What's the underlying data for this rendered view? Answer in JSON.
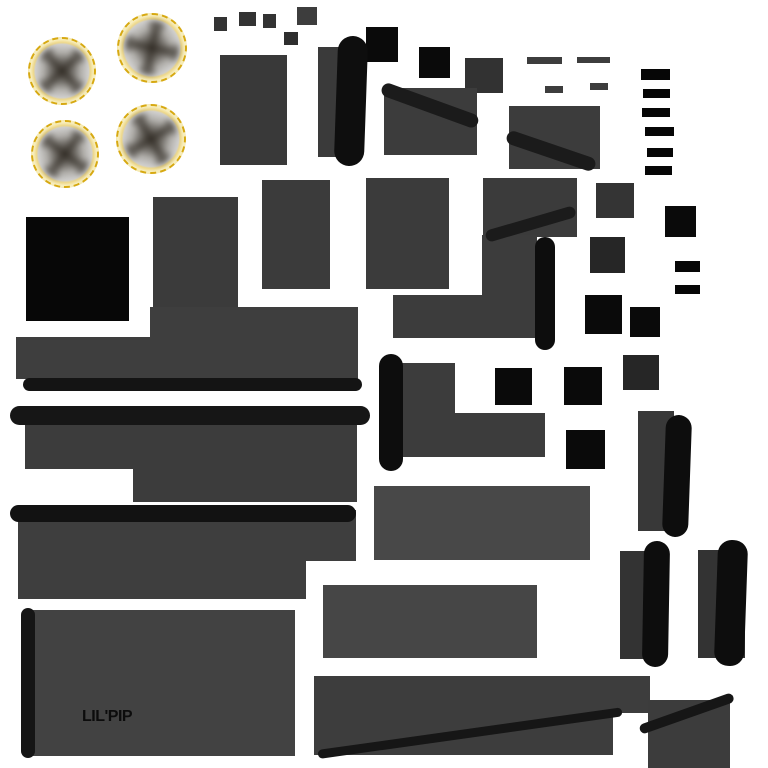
{
  "canvas": {
    "width": 768,
    "height": 768,
    "background": "#ffffff"
  },
  "label": {
    "text": "LIL'PIP"
  },
  "palette": {
    "background": "#ffffff",
    "panel_gray": "#3a3a3a",
    "panel_gray_light": "#464646",
    "strap_black": "#0d0d0d",
    "bar_black": "#1b1b1b",
    "square_black": "#0a0a0a",
    "wheel_rim_gold": "#d7a912",
    "wheel_glow_gold": "#f6e8ad",
    "wheel_disc_gray": "#cfcecc",
    "label_color": "#0c0c0c"
  },
  "shapes": [
    {
      "name": "wheel-top-left",
      "kind": "wheel",
      "x": 28,
      "y": 37,
      "w": 68,
      "h": 68,
      "spoke_rot": 40
    },
    {
      "name": "wheel-top-right",
      "kind": "wheel",
      "x": 117,
      "y": 13,
      "w": 70,
      "h": 70,
      "spoke_rot": 5
    },
    {
      "name": "wheel-bottom-left",
      "kind": "wheel",
      "x": 31,
      "y": 120,
      "w": 68,
      "h": 68,
      "spoke_rot": 30
    },
    {
      "name": "wheel-bottom-right",
      "kind": "wheel",
      "x": 116,
      "y": 104,
      "w": 70,
      "h": 70,
      "spoke_rot": 52
    },
    {
      "name": "chip-1",
      "kind": "rect",
      "x": 214,
      "y": 17,
      "w": 13,
      "h": 14,
      "color": "#333333"
    },
    {
      "name": "chip-2",
      "kind": "rect",
      "x": 239,
      "y": 12,
      "w": 17,
      "h": 14,
      "color": "#333333"
    },
    {
      "name": "chip-3",
      "kind": "rect",
      "x": 263,
      "y": 14,
      "w": 13,
      "h": 14,
      "color": "#333333"
    },
    {
      "name": "chip-4",
      "kind": "rect",
      "x": 284,
      "y": 32,
      "w": 14,
      "h": 13,
      "color": "#2e2e2e"
    },
    {
      "name": "chip-5",
      "kind": "rect",
      "x": 297,
      "y": 7,
      "w": 20,
      "h": 18,
      "color": "#3d3d3d"
    },
    {
      "name": "dash-1",
      "kind": "rect",
      "x": 527,
      "y": 57,
      "w": 35,
      "h": 7,
      "color": "#3d3d3d"
    },
    {
      "name": "dash-2",
      "kind": "rect",
      "x": 577,
      "y": 57,
      "w": 33,
      "h": 6,
      "color": "#3d3d3d"
    },
    {
      "name": "dash-3",
      "kind": "rect",
      "x": 545,
      "y": 86,
      "w": 18,
      "h": 7,
      "color": "#3d3d3d"
    },
    {
      "name": "dash-4",
      "kind": "rect",
      "x": 590,
      "y": 83,
      "w": 18,
      "h": 7,
      "color": "#3d3d3d"
    },
    {
      "name": "black-dash-1",
      "kind": "rect",
      "x": 641,
      "y": 69,
      "w": 29,
      "h": 11,
      "color": "#060606"
    },
    {
      "name": "black-dash-2",
      "kind": "rect",
      "x": 643,
      "y": 89,
      "w": 27,
      "h": 9,
      "color": "#060606"
    },
    {
      "name": "black-dash-3",
      "kind": "rect",
      "x": 642,
      "y": 108,
      "w": 28,
      "h": 9,
      "color": "#060606"
    },
    {
      "name": "black-dash-4",
      "kind": "rect",
      "x": 645,
      "y": 127,
      "w": 29,
      "h": 9,
      "color": "#060606"
    },
    {
      "name": "black-dash-5",
      "kind": "rect",
      "x": 647,
      "y": 148,
      "w": 26,
      "h": 9,
      "color": "#060606"
    },
    {
      "name": "black-dash-6",
      "kind": "rect",
      "x": 645,
      "y": 166,
      "w": 27,
      "h": 9,
      "color": "#060606"
    },
    {
      "name": "black-dash-7",
      "kind": "rect",
      "x": 675,
      "y": 261,
      "w": 25,
      "h": 11,
      "color": "#060606"
    },
    {
      "name": "black-dash-8",
      "kind": "rect",
      "x": 675,
      "y": 285,
      "w": 25,
      "h": 9,
      "color": "#060606"
    },
    {
      "name": "black-square-1",
      "kind": "rect",
      "x": 366,
      "y": 27,
      "w": 32,
      "h": 35,
      "color": "#0a0a0a"
    },
    {
      "name": "black-square-2",
      "kind": "rect",
      "x": 419,
      "y": 47,
      "w": 31,
      "h": 31,
      "color": "#0a0a0a"
    },
    {
      "name": "black-square-3",
      "kind": "rect",
      "x": 665,
      "y": 206,
      "w": 31,
      "h": 31,
      "color": "#0a0a0a"
    },
    {
      "name": "black-square-4",
      "kind": "rect",
      "x": 26,
      "y": 217,
      "w": 103,
      "h": 104,
      "color": "#070707"
    },
    {
      "name": "black-square-5",
      "kind": "rect",
      "x": 585,
      "y": 295,
      "w": 37,
      "h": 39,
      "color": "#0a0a0a"
    },
    {
      "name": "black-square-6",
      "kind": "rect",
      "x": 630,
      "y": 307,
      "w": 30,
      "h": 30,
      "color": "#0a0a0a"
    },
    {
      "name": "black-square-7",
      "kind": "rect",
      "x": 495,
      "y": 368,
      "w": 37,
      "h": 37,
      "color": "#0a0a0a"
    },
    {
      "name": "black-square-8",
      "kind": "rect",
      "x": 564,
      "y": 367,
      "w": 38,
      "h": 38,
      "color": "#0a0a0a"
    },
    {
      "name": "black-square-9",
      "kind": "rect",
      "x": 566,
      "y": 430,
      "w": 39,
      "h": 39,
      "color": "#0a0a0a"
    },
    {
      "name": "dark-square-1",
      "kind": "rect",
      "x": 465,
      "y": 58,
      "w": 38,
      "h": 35,
      "color": "#323232"
    },
    {
      "name": "dark-square-2",
      "kind": "rect",
      "x": 596,
      "y": 183,
      "w": 38,
      "h": 35,
      "color": "#343434"
    },
    {
      "name": "dark-square-3",
      "kind": "rect",
      "x": 590,
      "y": 237,
      "w": 35,
      "h": 36,
      "color": "#262626"
    },
    {
      "name": "dark-square-4",
      "kind": "rect",
      "x": 623,
      "y": 355,
      "w": 36,
      "h": 35,
      "color": "#262626"
    },
    {
      "name": "panel-a",
      "kind": "rect",
      "x": 220,
      "y": 55,
      "w": 67,
      "h": 110,
      "color": "#393939"
    },
    {
      "name": "panel-b",
      "kind": "rect",
      "x": 318,
      "y": 47,
      "w": 43,
      "h": 110,
      "color": "#3a3a3a"
    },
    {
      "name": "strap-band-b",
      "kind": "band",
      "x": 336,
      "y": 36,
      "w": 30,
      "h": 130,
      "color": "#0e0e0e",
      "radius": 15,
      "rot": 2
    },
    {
      "name": "panel-c",
      "kind": "rect",
      "x": 384,
      "y": 88,
      "w": 93,
      "h": 67,
      "color": "#3c3c3c"
    },
    {
      "name": "diag-bar-c",
      "kind": "bar",
      "x": 382,
      "y": 81,
      "w": 102,
      "h": 14,
      "color": "#1b1b1b",
      "radius": 7,
      "rot": 20
    },
    {
      "name": "panel-d1",
      "kind": "rect",
      "x": 509,
      "y": 106,
      "w": 91,
      "h": 63,
      "color": "#3c3c3c"
    },
    {
      "name": "diag-bar-d1",
      "kind": "bar",
      "x": 507,
      "y": 129,
      "w": 93,
      "h": 14,
      "color": "#1b1b1b",
      "radius": 7,
      "rot": 18.8
    },
    {
      "name": "panel-t",
      "kind": "rect",
      "x": 153,
      "y": 197,
      "w": 85,
      "h": 110,
      "color": "#3b3b3b"
    },
    {
      "name": "panel-e1",
      "kind": "rect",
      "x": 262,
      "y": 180,
      "w": 68,
      "h": 109,
      "color": "#3b3b3b"
    },
    {
      "name": "panel-e2",
      "kind": "rect",
      "x": 366,
      "y": 178,
      "w": 83,
      "h": 111,
      "color": "#3b3b3b"
    },
    {
      "name": "panel-f",
      "kind": "rect",
      "x": 483,
      "y": 178,
      "w": 94,
      "h": 59,
      "color": "#3b3b3b"
    },
    {
      "name": "panel-u1",
      "kind": "rect",
      "x": 482,
      "y": 235,
      "w": 55,
      "h": 103,
      "color": "#3c3c3c"
    },
    {
      "name": "panel-u2",
      "kind": "rect",
      "x": 393,
      "y": 295,
      "w": 89,
      "h": 43,
      "color": "#3c3c3c"
    },
    {
      "name": "diag-bar-f",
      "kind": "bar",
      "x": 486,
      "y": 231,
      "w": 93,
      "h": 12,
      "color": "#1b1b1b",
      "radius": 6,
      "rot": -16.3
    },
    {
      "name": "strap-pill-v",
      "kind": "pill",
      "x": 535,
      "y": 237,
      "w": 20,
      "h": 113,
      "color": "#0d0d0d",
      "radius": 10
    },
    {
      "name": "panel-g1",
      "kind": "rect",
      "x": 150,
      "y": 307,
      "w": 208,
      "h": 31,
      "color": "#3e3e3e"
    },
    {
      "name": "panel-g2",
      "kind": "rect",
      "x": 16,
      "y": 337,
      "w": 342,
      "h": 42,
      "color": "#3e3e3e"
    },
    {
      "name": "strap-pill-1",
      "kind": "pill",
      "x": 23,
      "y": 378,
      "w": 339,
      "h": 13,
      "color": "#141414",
      "radius": 7
    },
    {
      "name": "strap-pill-2",
      "kind": "pill",
      "x": 10,
      "y": 406,
      "w": 360,
      "h": 19,
      "color": "#161616",
      "radius": 10
    },
    {
      "name": "panel-h1",
      "kind": "rect",
      "x": 25,
      "y": 425,
      "w": 332,
      "h": 44,
      "color": "#3c3c3c"
    },
    {
      "name": "panel-h2",
      "kind": "rect",
      "x": 133,
      "y": 468,
      "w": 224,
      "h": 34,
      "color": "#3c3c3c"
    },
    {
      "name": "panel-x1",
      "kind": "rect",
      "x": 390,
      "y": 363,
      "w": 65,
      "h": 94,
      "color": "#3c3c3c"
    },
    {
      "name": "panel-x2",
      "kind": "rect",
      "x": 455,
      "y": 413,
      "w": 90,
      "h": 44,
      "color": "#3c3c3c"
    },
    {
      "name": "strap-pill-w",
      "kind": "pill",
      "x": 379,
      "y": 354,
      "w": 24,
      "h": 117,
      "color": "#0d0d0d",
      "radius": 12
    },
    {
      "name": "panel-j1",
      "kind": "rect",
      "x": 18,
      "y": 510,
      "w": 338,
      "h": 51,
      "color": "#3e3e3e"
    },
    {
      "name": "panel-j2",
      "kind": "rect",
      "x": 18,
      "y": 560,
      "w": 288,
      "h": 39,
      "color": "#3e3e3e"
    },
    {
      "name": "strap-pill-3",
      "kind": "pill",
      "x": 10,
      "y": 505,
      "w": 346,
      "h": 17,
      "color": "#121212",
      "radius": 9
    },
    {
      "name": "panel-l",
      "kind": "rect",
      "x": 374,
      "y": 486,
      "w": 216,
      "h": 74,
      "color": "#484848"
    },
    {
      "name": "panel-n",
      "kind": "rect",
      "x": 323,
      "y": 585,
      "w": 214,
      "h": 73,
      "color": "#464646"
    },
    {
      "name": "panel-k",
      "kind": "rect",
      "x": 23,
      "y": 610,
      "w": 272,
      "h": 146,
      "color": "#424242"
    },
    {
      "name": "strap-pill-k",
      "kind": "pill",
      "x": 21,
      "y": 608,
      "w": 14,
      "h": 150,
      "color": "#151515",
      "radius": 7
    },
    {
      "name": "panel-o1",
      "kind": "rect",
      "x": 314,
      "y": 676,
      "w": 336,
      "h": 37,
      "color": "#3d3d3d"
    },
    {
      "name": "panel-o2",
      "kind": "rect",
      "x": 314,
      "y": 712,
      "w": 299,
      "h": 43,
      "color": "#3d3d3d"
    },
    {
      "name": "diag-bar-o",
      "kind": "bar",
      "x": 318,
      "y": 750,
      "w": 307,
      "h": 9,
      "color": "#161616",
      "radius": 5,
      "rot": -8
    },
    {
      "name": "panel-s",
      "kind": "rect",
      "x": 648,
      "y": 700,
      "w": 82,
      "h": 68,
      "color": "#3c3c3c"
    },
    {
      "name": "diag-bar-s",
      "kind": "bar",
      "x": 640,
      "y": 725,
      "w": 99,
      "h": 10,
      "color": "#161616",
      "radius": 5,
      "rot": -19.5
    },
    {
      "name": "strap-p-panel",
      "kind": "rect",
      "x": 638,
      "y": 411,
      "w": 36,
      "h": 120,
      "color": "#383838"
    },
    {
      "name": "strap-p-band",
      "kind": "band",
      "x": 664,
      "y": 415,
      "w": 26,
      "h": 122,
      "color": "#0d0d0d",
      "radius": 13,
      "rot": 2
    },
    {
      "name": "strap-q-panel",
      "kind": "rect",
      "x": 620,
      "y": 551,
      "w": 42,
      "h": 108,
      "color": "#333333"
    },
    {
      "name": "strap-q-band",
      "kind": "band",
      "x": 643,
      "y": 541,
      "w": 26,
      "h": 126,
      "color": "#0d0d0d",
      "radius": 13,
      "rot": 1
    },
    {
      "name": "strap-r-panel",
      "kind": "rect",
      "x": 698,
      "y": 550,
      "w": 47,
      "h": 108,
      "color": "#333333"
    },
    {
      "name": "strap-r-band",
      "kind": "band",
      "x": 716,
      "y": 540,
      "w": 30,
      "h": 126,
      "color": "#0d0d0d",
      "radius": 14,
      "rot": 2
    }
  ]
}
